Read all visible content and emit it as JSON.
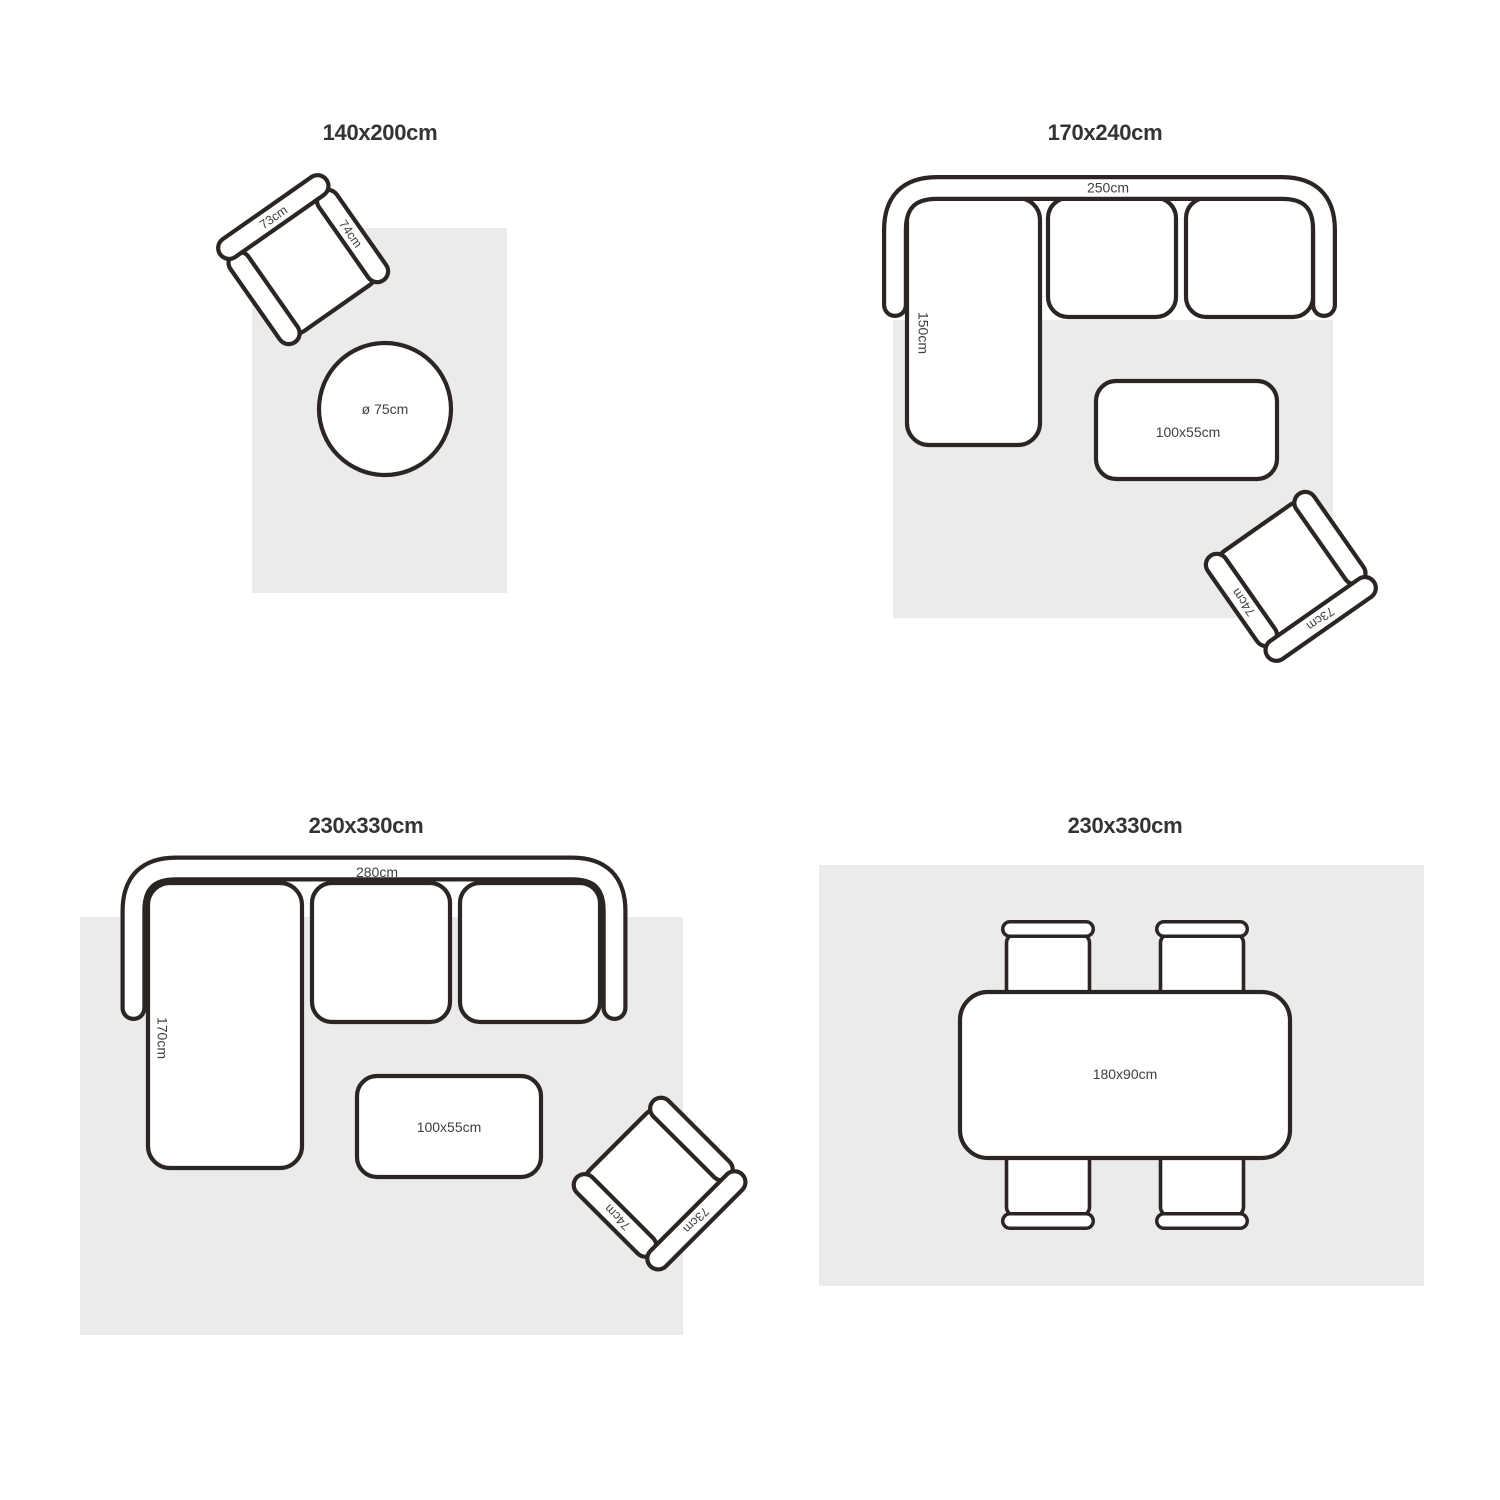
{
  "colors": {
    "outline": "#2b2523",
    "rug_fill": "#ebebeb",
    "label_text": "#3f3f3f",
    "title_text": "#343434",
    "background": "#ffffff"
  },
  "panels": [
    {
      "id": "rug-140x200",
      "title": "140x200cm",
      "furniture": {
        "armchair": {
          "width": "73cm",
          "depth": "74cm"
        },
        "round_table": {
          "diameter": "ø 75cm"
        }
      }
    },
    {
      "id": "rug-170x240",
      "title": "170x240cm",
      "furniture": {
        "sofa": {
          "width": "250cm",
          "chaise_depth": "150cm"
        },
        "coffee_table": {
          "size": "100x55cm"
        },
        "armchair": {
          "width": "73cm",
          "depth": "74cm"
        }
      }
    },
    {
      "id": "rug-230x330-living",
      "title": "230x330cm",
      "furniture": {
        "sofa": {
          "width": "280cm",
          "chaise_depth": "170cm"
        },
        "coffee_table": {
          "size": "100x55cm"
        },
        "armchair": {
          "width": "73cm",
          "depth": "74cm"
        }
      }
    },
    {
      "id": "rug-230x330-dining",
      "title": "230x330cm",
      "furniture": {
        "dining_table": {
          "size": "180x90cm"
        },
        "dining_chairs_count": 4
      }
    }
  ]
}
